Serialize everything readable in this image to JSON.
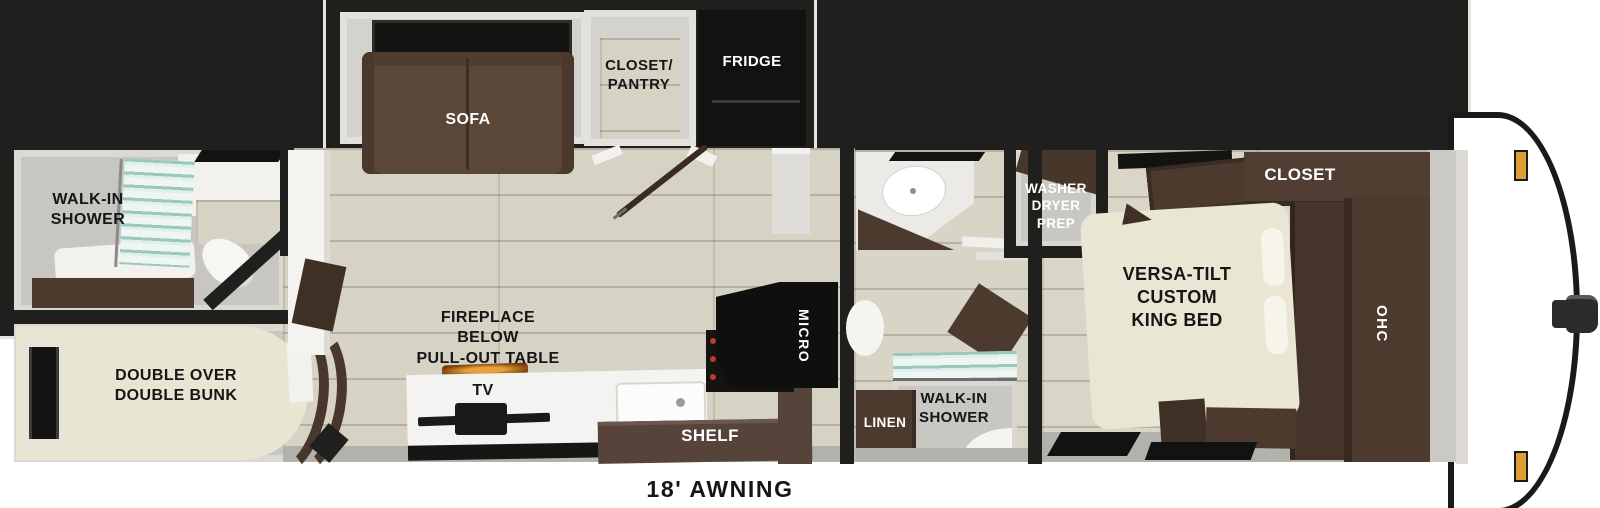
{
  "floorplan": {
    "type": "travel-trailer floor plan",
    "labels": {
      "rear_bath_shower": "WALK-IN\nSHOWER",
      "bunk": "DOUBLE OVER\nDOUBLE BUNK",
      "sofa": "SOFA",
      "closet_pantry": "CLOSET/\nPANTRY",
      "fridge": "FRIDGE",
      "fireplace": "FIREPLACE\nBELOW\nPULL-OUT TABLE",
      "tv": "TV",
      "shelf": "SHELF",
      "micro": "MICRO",
      "mid_bath_shower": "WALK-IN\nSHOWER",
      "linen": "LINEN",
      "washer": "WASHER\nDRYER\nPREP",
      "king_bed": "VERSA-TILT\nCUSTOM\nKING BED",
      "closet": "CLOSET",
      "ohc": "OHC",
      "awning": "18' AWNING"
    },
    "colors": {
      "wall": "#1f1f1d",
      "wood_floor": "#d6d2c4",
      "room_gray": "#c8c6c0",
      "cabinet_brown": "#4c3a2f",
      "sofa_brown": "#5a4737",
      "mattress_beige": "#e9e5d3",
      "appliance_black": "#121210",
      "glass_teal": "#9cc7bc",
      "marker_light": "#dd9e35",
      "fire_glow": "#e08b28"
    }
  }
}
